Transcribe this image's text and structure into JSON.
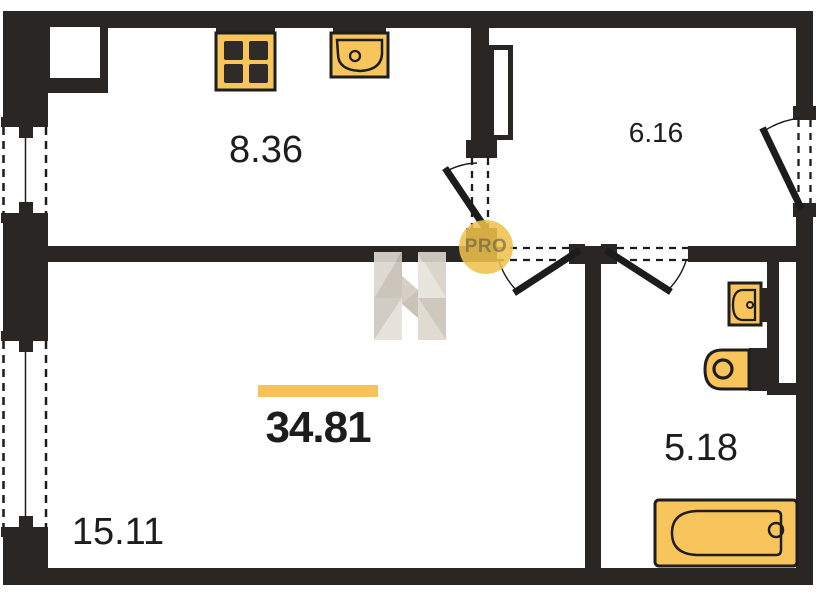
{
  "plan": {
    "type": "apartment-floor-plan",
    "total": {
      "area": "34.81"
    },
    "rooms": [
      {
        "name": "kitchen",
        "area": "8.36"
      },
      {
        "name": "hallway",
        "area": "6.16"
      },
      {
        "name": "living-room",
        "area": "15.11"
      },
      {
        "name": "bathroom",
        "area": "5.18"
      }
    ],
    "watermark": {
      "pro": "PRO"
    },
    "icons": {
      "stove": "4-burner-cooktop",
      "kitchen_sink": "kitchen-sink-basin",
      "bathroom_sink": "washbasin",
      "toilet": "toilet-with-cistern",
      "bathtub": "bathtub"
    },
    "colors": {
      "wall": "#292623",
      "fixture_fill": "#F8C45C",
      "fixture_stroke": "#1e1e1e",
      "accent_bar": "#F5C25C",
      "watermark_circle": "#EFC14D",
      "background": "#ffffff"
    }
  }
}
